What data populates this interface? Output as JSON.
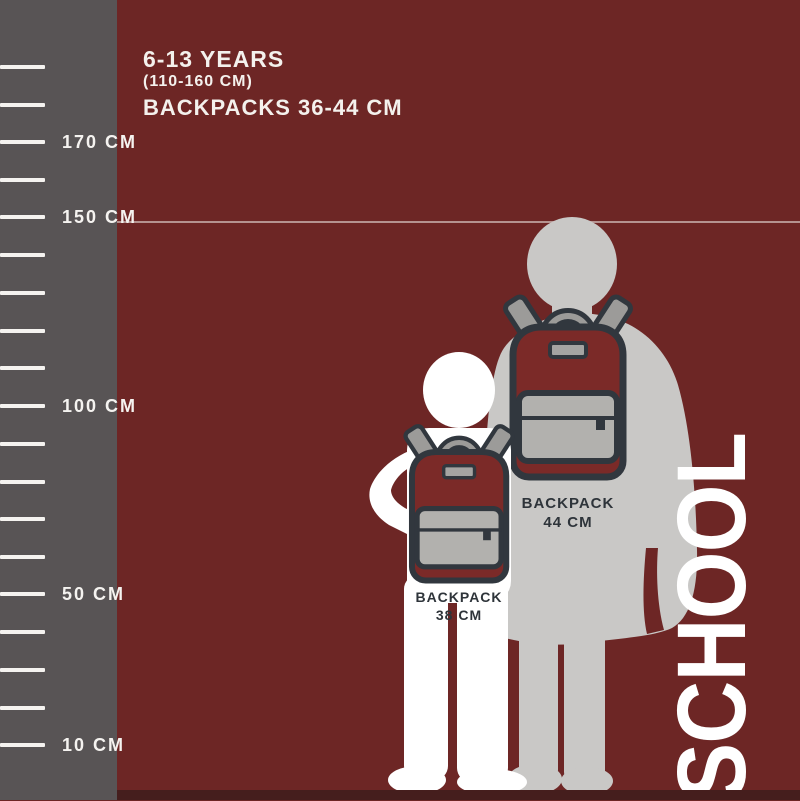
{
  "header": {
    "age_range": "6-13 YEARS",
    "height_range": "(110-160 CM)",
    "backpack_range": "BACKPACKS 36-44 CM"
  },
  "ruler": {
    "labels": [
      "170 CM",
      "150 CM",
      "100 CM",
      "50 CM",
      "10 CM"
    ]
  },
  "backpacks": {
    "large": {
      "name": "BACKPACK",
      "size": "44 CM"
    },
    "small": {
      "name": "BACKPACK",
      "size": "38 CM"
    }
  },
  "side_text": "SCHOOL",
  "colors": {
    "background": "#6D2625",
    "sidebar": "#585455",
    "outline_dark": "#31373E",
    "backpack_body": "#7B2A28",
    "strap_gray": "#9C9B99",
    "pocket_gray": "#B2B1AE",
    "patch_gray": "#A5A4A2",
    "silhouette_large": "#C9C8C6",
    "silhouette_small": "#FFFFFF",
    "bottom_strip": "#451E1D",
    "label_text": "#2E343A",
    "header_text": "#F4F1ED"
  }
}
